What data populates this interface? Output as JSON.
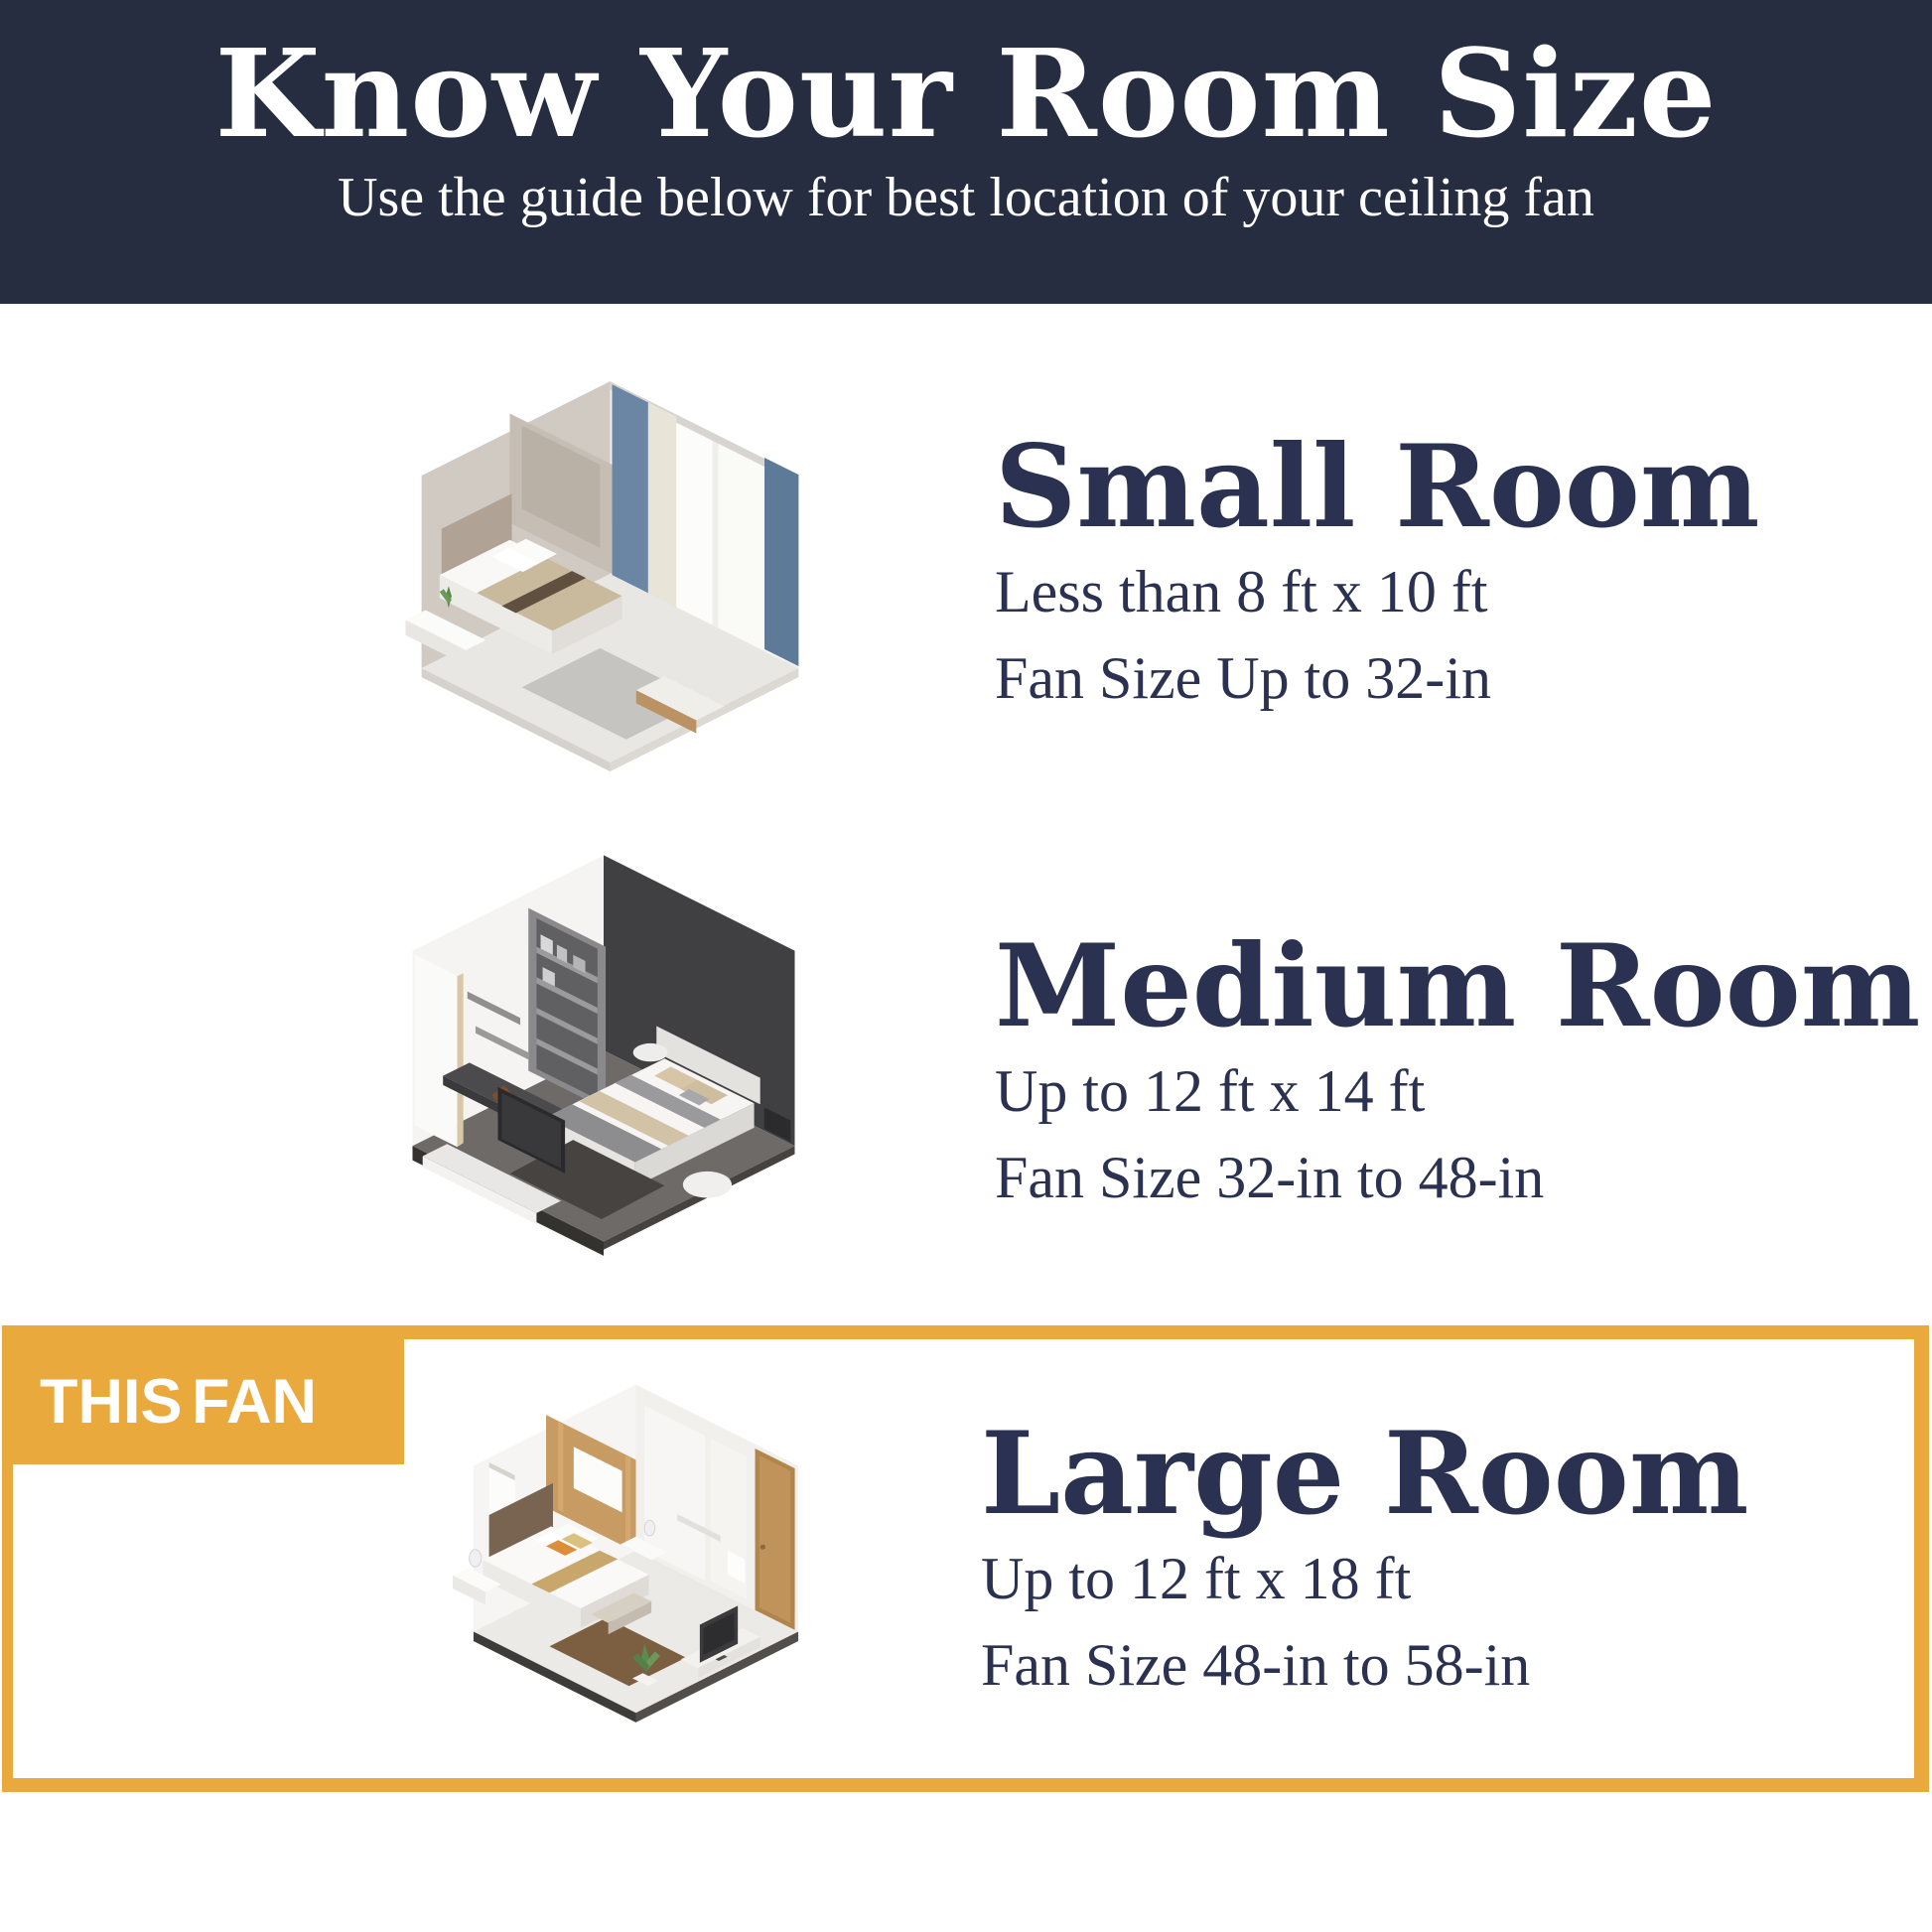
{
  "theme": {
    "navy": "#262d40",
    "ink": "#2b3150",
    "orange": "#eaa93c",
    "paper": "#ffffff"
  },
  "header": {
    "title": "Know Your Room Size",
    "subtitle": "Use the guide below for best location of your ceiling fan"
  },
  "sections": [
    {
      "id": "small",
      "title": "Small Room",
      "dimensions": "Less than 8 ft x 10 ft",
      "fan_size": "Fan Size Up to 32-in",
      "illustration": "small-room-isometric-bedroom"
    },
    {
      "id": "medium",
      "title": "Medium Room",
      "dimensions": "Up to 12 ft x 14 ft",
      "fan_size": "Fan Size 32-in to 48-in",
      "illustration": "medium-room-isometric-bedroom"
    },
    {
      "id": "large",
      "title": "Large Room",
      "dimensions": "Up to 12 ft x 18 ft",
      "fan_size": "Fan Size 48-in to 58-in",
      "highlighted": true,
      "badge": "THIS FAN",
      "illustration": "large-room-isometric-bedroom"
    }
  ]
}
